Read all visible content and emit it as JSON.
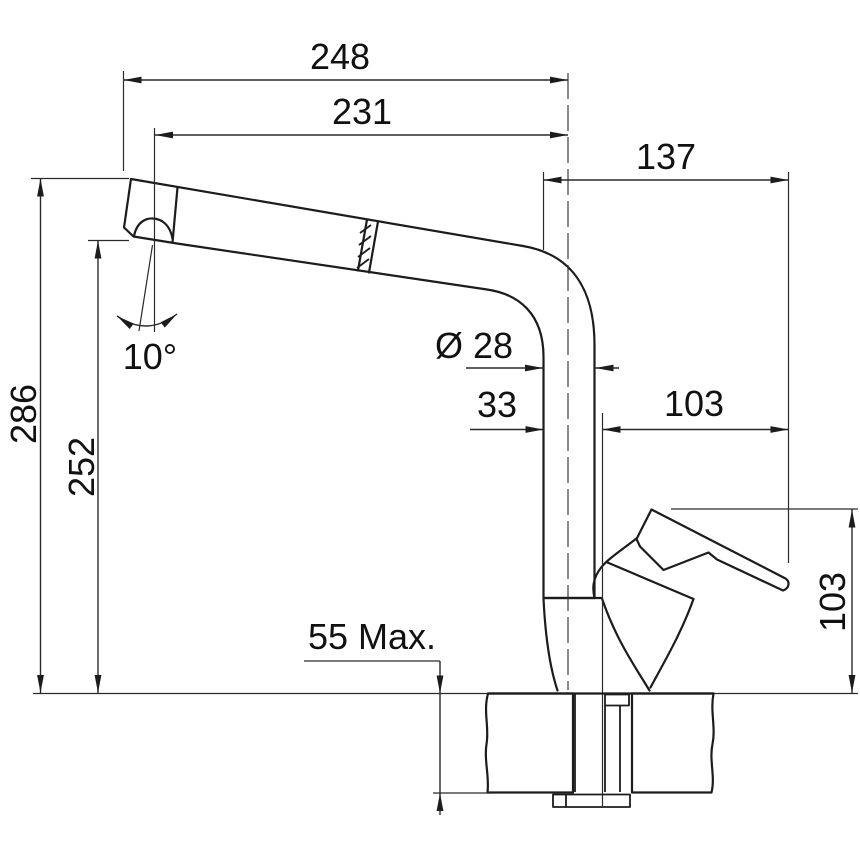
{
  "drawing": {
    "subject": "kitchen-faucet-pull-out-spray-side-view-technical-drawing",
    "background_color": "#ffffff",
    "line_color": "#1c1c1c"
  },
  "dimensions": {
    "overall_reach": "248",
    "spout_reach": "231",
    "rear_reach": "137",
    "overall_height": "286",
    "outlet_height": "252",
    "head_angle": "10°",
    "spout_diameter": "Ø 28",
    "axis_offset": "33",
    "rear_offset": "103",
    "deck_thickness": "55 Max.",
    "handle_height": "103"
  }
}
